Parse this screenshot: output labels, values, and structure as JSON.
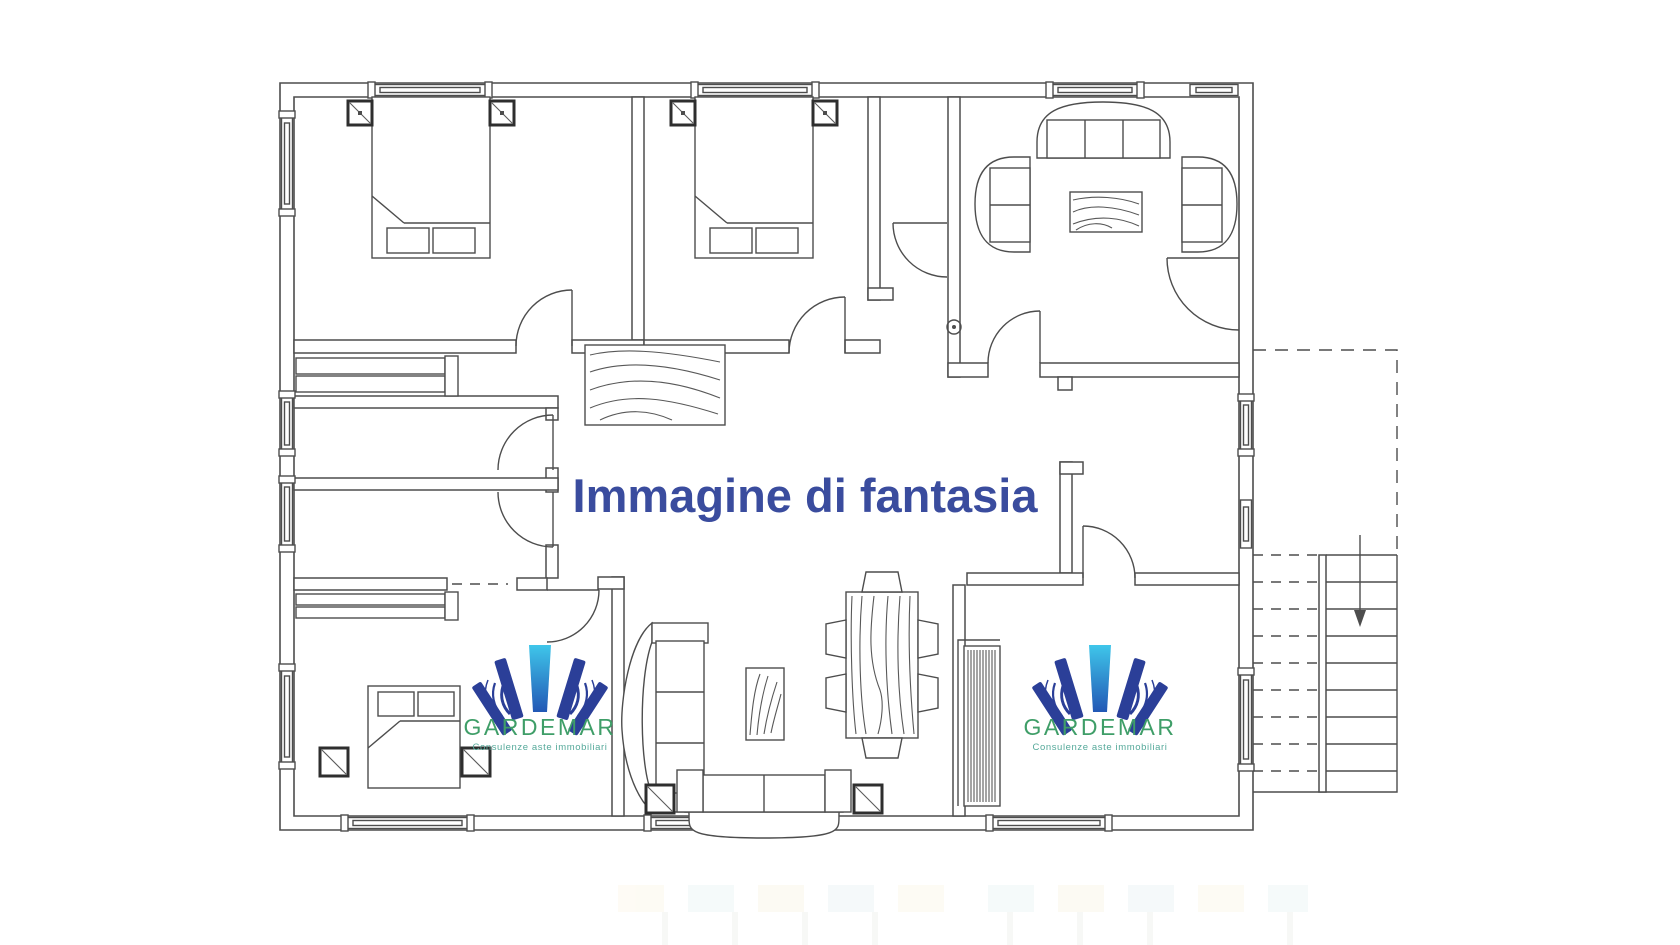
{
  "watermark": {
    "text": "Immagine di fantasia",
    "color": "#3a4c9e"
  },
  "brand": {
    "name": "GARDEMAR",
    "tagline": "Consulenze aste immobiliari",
    "name_color": "#3f9e68",
    "tagline_color": "#55a99a",
    "fan_dark": "#2b3f98",
    "fan_light": "#3fc6ea",
    "fan_mid": "#2257b5"
  },
  "canvas": {
    "background": "#ffffff",
    "line_color": "#4d4d4d"
  },
  "floor_plan": {
    "type": "apartment-floor-plan",
    "rooms": [
      "bedroom-top-left",
      "bedroom-top-middle",
      "living-room-top-right",
      "bathroom-1",
      "bathroom-2",
      "bedroom-bottom-left",
      "central-hall",
      "dining-living-area",
      "bottom-right-room",
      "external-staircase"
    ],
    "furniture": [
      "double-bed",
      "double-bed",
      "single-bed",
      "nightstand-squares",
      "wardrobe-shelves",
      "sofa-curved-top",
      "armchair-left",
      "armchair-right",
      "coffee-table-wood",
      "hall-rug-wood",
      "vertical-sofa",
      "side-table-wood",
      "dining-table-wood",
      "dining-chairs-6",
      "bottom-sofa",
      "hatched-wardrobe",
      "stair-treads",
      "stair-down-arrow"
    ],
    "features": [
      "windows-double-line",
      "door-quarter-arcs",
      "dashed-upper-stair-flight"
    ]
  },
  "artifact_strip": {
    "block_colors": [
      "#fdf8ec",
      "#eef6f6",
      "#fbf6ea",
      "#edf5f7",
      "#fdf8ec",
      "#eef6f6",
      "#fbf6ea",
      "#edf5f7",
      "#fdf8ec",
      "#eef6f6"
    ]
  }
}
